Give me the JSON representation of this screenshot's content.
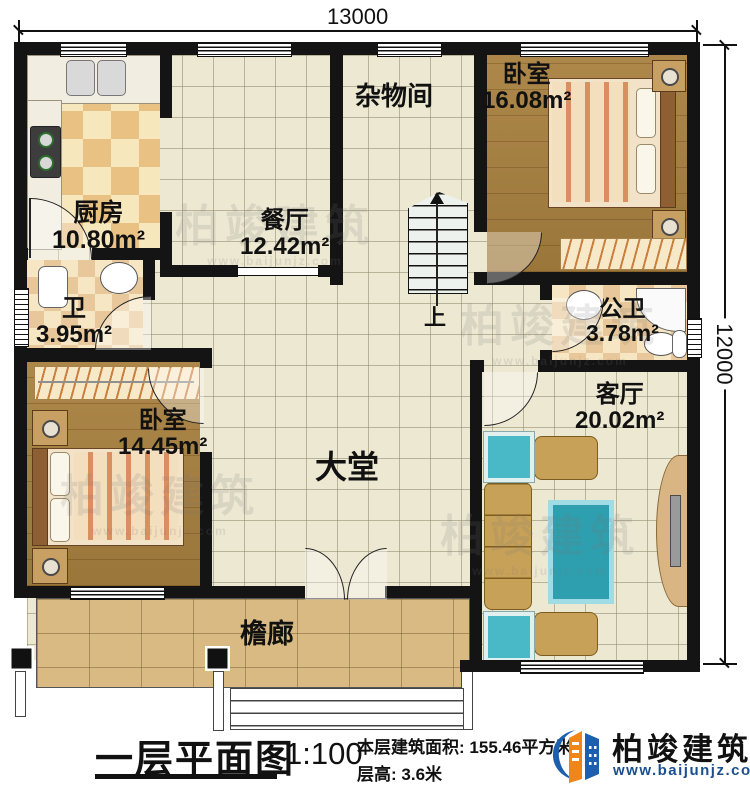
{
  "dimensions": {
    "width_label": "13000",
    "height_label": "12000"
  },
  "rooms": {
    "kitchen": {
      "name": "厨房",
      "area": "10.80m²"
    },
    "dining": {
      "name": "餐厅",
      "area": "12.42m²"
    },
    "storage": {
      "name": "杂物间",
      "area": ""
    },
    "bedroom_top": {
      "name": "卧室",
      "area": "16.08m²"
    },
    "bath": {
      "name": "卫",
      "area": "3.95m²"
    },
    "public_bath": {
      "name": "公卫",
      "area": "3.78m²"
    },
    "bedroom_left": {
      "name": "卧室",
      "area": "14.45m²"
    },
    "hall": {
      "name": "大堂",
      "area": ""
    },
    "living": {
      "name": "客厅",
      "area": "20.02m²"
    },
    "porch": {
      "name": "檐廊",
      "area": ""
    }
  },
  "stairs": {
    "up_label": "上"
  },
  "title_block": {
    "title": "一层平面图",
    "scale": "1:100",
    "area_label": "本层建筑面积:",
    "area_value": "155.46平方米",
    "floor_height_label": "层高:",
    "floor_height_value": "3.6米"
  },
  "brand": {
    "name": "柏竣建筑",
    "website": "www.baijunjz.com"
  },
  "watermark": {
    "text": "柏竣建筑",
    "subtext": "www.baijunjz.com"
  },
  "colors": {
    "wall": "#141414",
    "accent_orange": "#f08519",
    "accent_blue": "#1b5fae",
    "brand_url_blue": "#1c4f8f"
  }
}
